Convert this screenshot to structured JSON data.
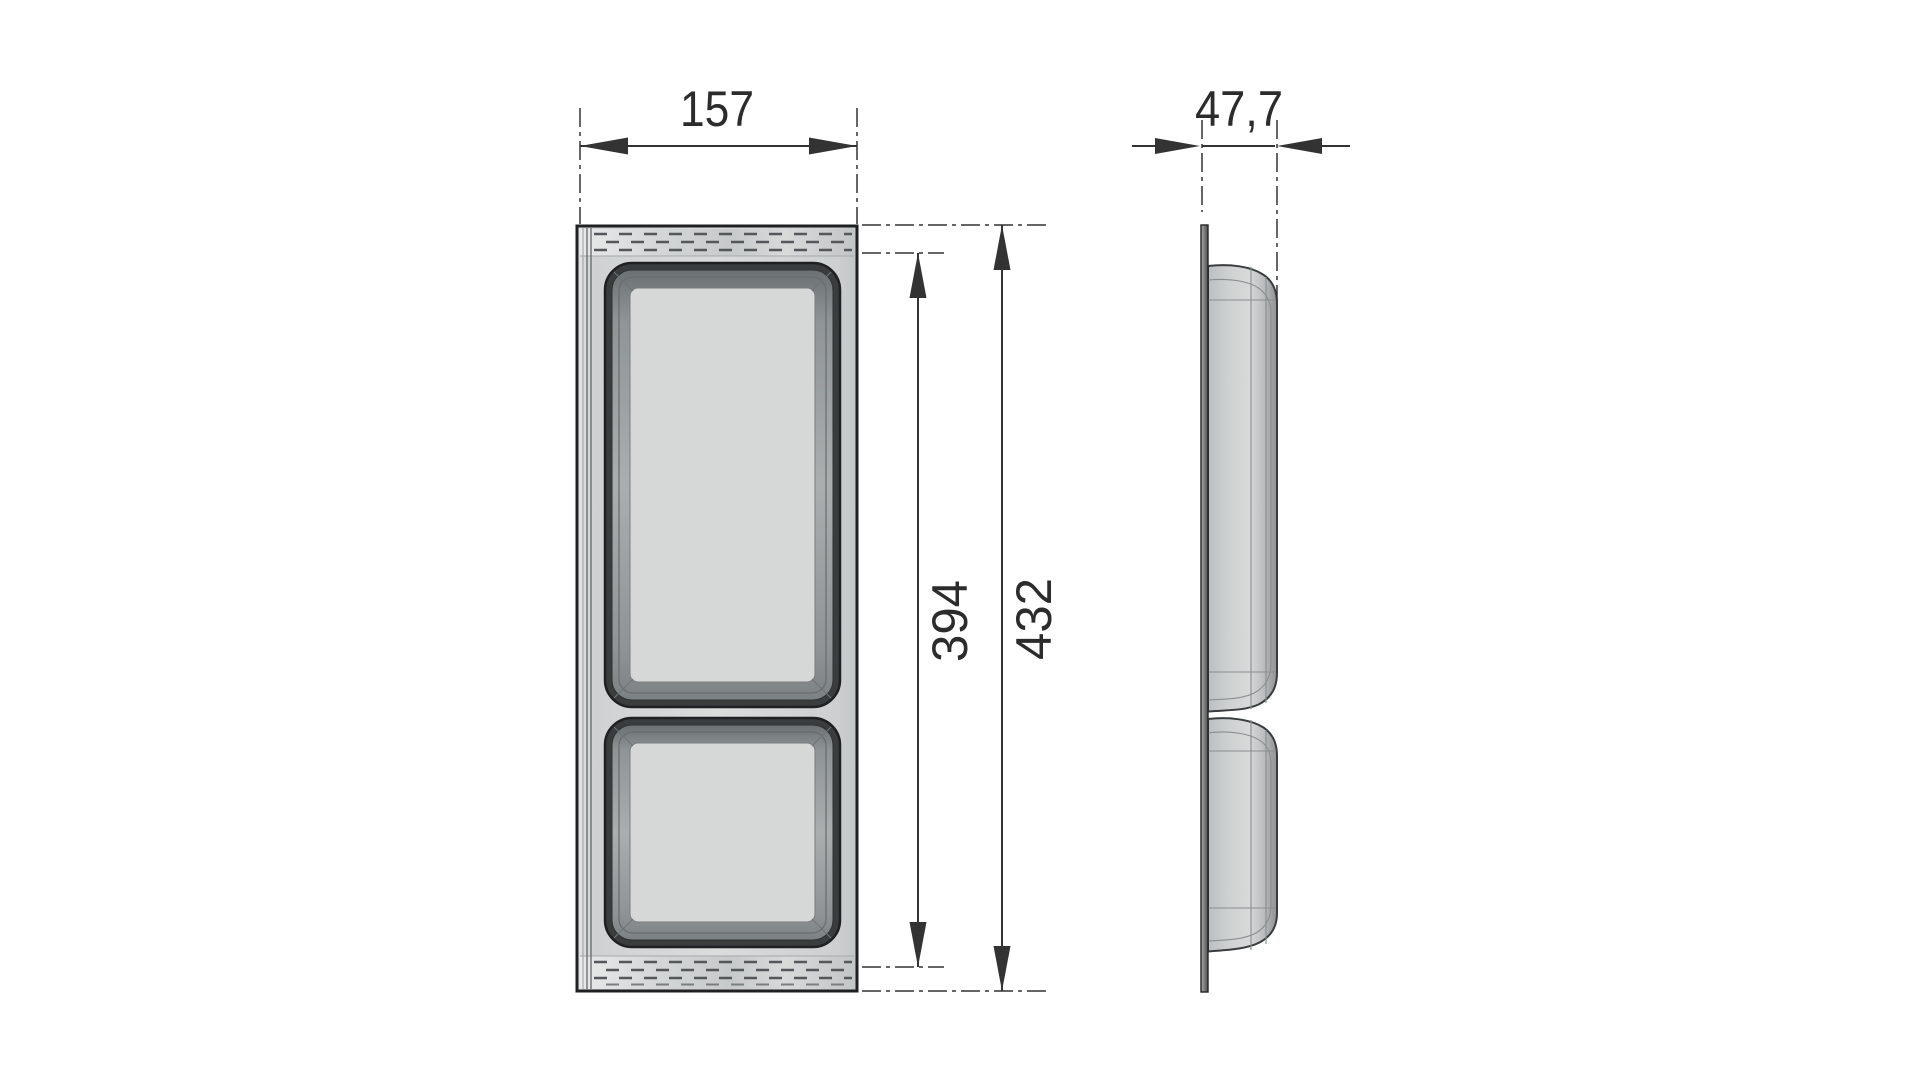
{
  "drawing": {
    "type": "technical-orthographic-drawing",
    "dimensions": {
      "overall_width": "157",
      "depth": "47,7",
      "recess_height": "394",
      "overall_height": "432"
    },
    "colors": {
      "background": "#ffffff",
      "dimension_line": "#333333",
      "dimension_text": "#2c2c2c",
      "outline": "#1e2021",
      "rim": "#3a3d3e",
      "floor": "#d6d8d8",
      "hatch": "#54585a"
    }
  }
}
